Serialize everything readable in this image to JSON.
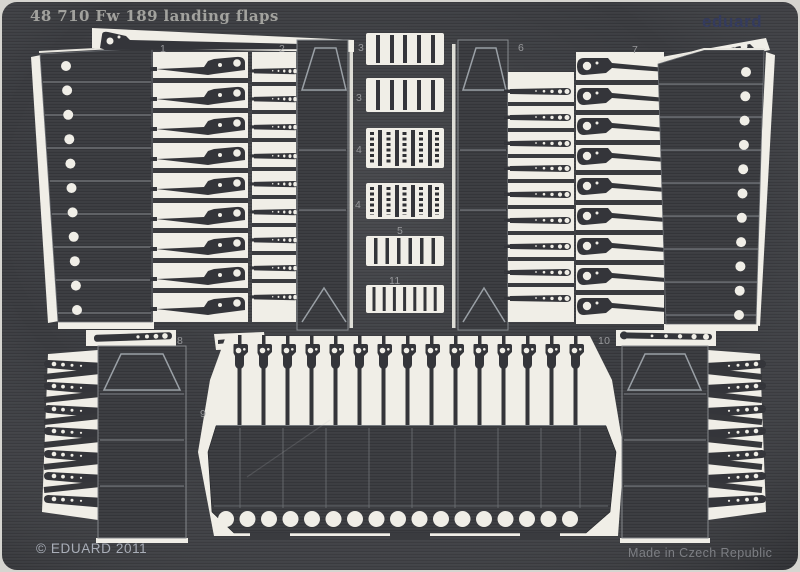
{
  "header": {
    "title": "48 710  Fw 189 landing flaps",
    "brand": "eduard"
  },
  "footer": {
    "copyright": "© EDUARD 2011",
    "origin": "Made in Czech Republic"
  },
  "part_labels": {
    "p1": "1",
    "p2": "2",
    "p3a": "3",
    "p3b": "3",
    "p4a": "4",
    "p4b": "4",
    "p5": "5",
    "p6": "6",
    "p7": "7",
    "p8": "8",
    "p9": "9",
    "p10": "10",
    "p11": "11"
  },
  "colors": {
    "sheet_metal": "#3a3b3f",
    "etched_background": "#f0eee7",
    "brand_blue": "#343b5e",
    "label_gray": "#97989b"
  }
}
